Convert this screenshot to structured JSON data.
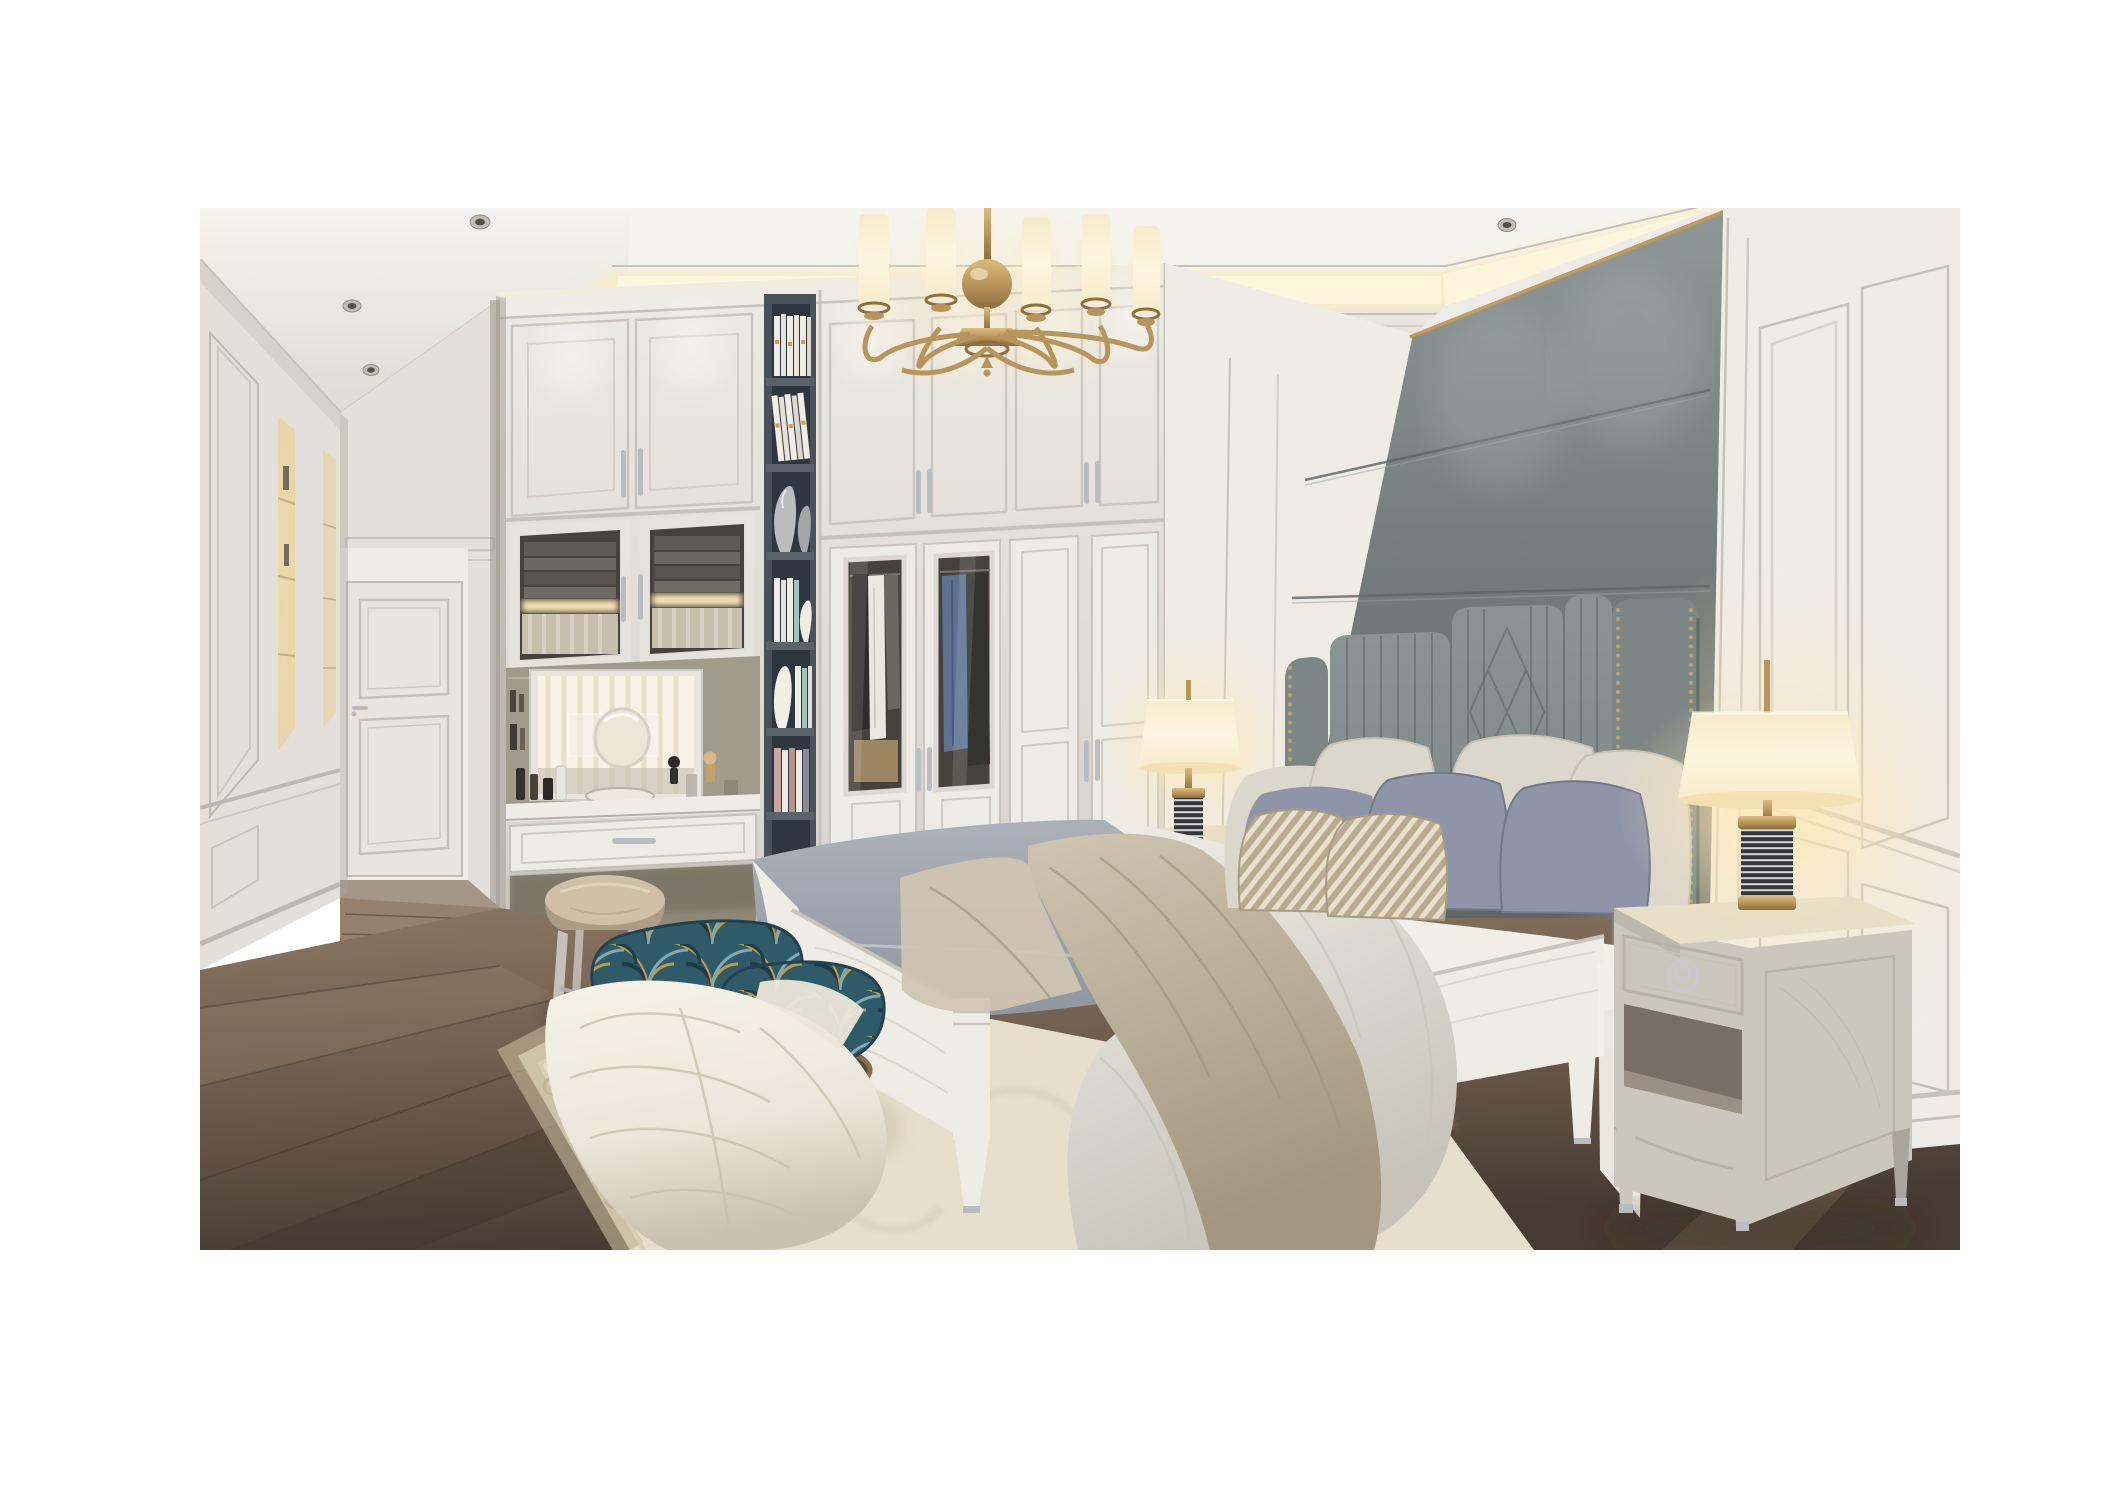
{
  "image": {
    "type": "3d-interior-render",
    "subject": "luxury neoclassical bedroom with built-in white wardrobes, gray upholstered headboard wall, vanity nook and hallway",
    "room_features": [
      "tray ceiling with warm cove lighting",
      "recessed ceiling downlights",
      "brass chandelier with cylindrical white shades",
      "white classical wall paneling and wainscot",
      "gray-green upholstered feature wall with brass trim line",
      "channel-tufted headboard with nailhead wings and diamond quilting",
      "built-in white wardrobe with two glass garment doors",
      "dark slate open bookshelf column with books and vases",
      "vanity nook with mirror, cosmetics and leather stool",
      "hallway with white paneled door and lit display niches",
      "dark stained oak plank flooring",
      "cream damask area rug"
    ],
    "furniture": {
      "bed": "white wood frame, gray fitted mattress, white duvet, taupe throw",
      "pillows": {
        "cream_large": 4,
        "lavender_gray": 3,
        "striped_accent": 2
      },
      "nightstands": 2,
      "table_lamps": 2,
      "bench": "teal and gold fan-patterned upholstery with bronze legs and cream throw",
      "stool": "round beige leather vanity stool",
      "side_table": "round bronze accent table with dark glass top"
    },
    "lighting": {
      "chandelier": {
        "material": "brushed brass",
        "visible_shades": 5,
        "arms": 6
      },
      "cove_light": "warm indirect",
      "downlights_visible": 16,
      "lamp_style": "cream drum shade, brass fittings, black-and-white ribbed column base"
    },
    "bookshelf": {
      "shelves": 6,
      "contents": [
        "white books with orange accents",
        "leaning white books",
        "two silver vases",
        "books and white ceramic vase",
        "tall white vase with books",
        "pink and white books"
      ]
    },
    "wardrobe": {
      "glass_doors": 2,
      "solid_lower_doors": 2,
      "upper_cabinet_doors": 5,
      "handle_finish": "polished chrome"
    }
  },
  "colors": {
    "ceilingLight": "#f5f3ef",
    "ceilingShade": "#d8d4ce",
    "coveGlow": "#ffedb8",
    "coveCore": "#fdf6dd",
    "wallWhite": "#efece7",
    "wallShade": "#d6d2cb",
    "wallWarm": "#e9e3d7",
    "wardrobeFace": "#edebe6",
    "wardrobeShade": "#d4d0c9",
    "panelLine": "#c6c2bb",
    "hallWall": "#e4e0d9",
    "doorFace": "#e9e5de",
    "shelfDark": "#49525b",
    "shelfInner": "#2e363f",
    "shelfEdge": "#5a636c",
    "bookWhite": "#f0ede6",
    "bookAccent": "#d99a4e",
    "bookTeal": "#9fc3bd",
    "bookPink": "#c9a8a2",
    "glassDark": "#45423e",
    "glassWarm": "#f3e0b0",
    "clothesDark": "#35342f",
    "clothesBlue": "#5d7291",
    "clothesWhite": "#e9e7e2",
    "mirrorBright": "#f8f3e6",
    "mirrorStripe": "#e6ddc8",
    "nicheOlive": "#a19b8b",
    "counterWhite": "#f0ede7",
    "grayWallTop": "#8d9795",
    "grayWall": "#75807e",
    "grayWallDark": "#5c6765",
    "goldTrim": "#c29a55",
    "headboard": "#7c8785",
    "headboardLight": "#8a9593",
    "headboardDark": "#59645f",
    "headboardNail": "#caa768",
    "bedWhite": "#efece5",
    "bedWhiteShade": "#d5d1c7",
    "mattress": "#abb1b9",
    "mattressShade": "#8f96a0",
    "duvet": "#f1eee8",
    "duvetShade": "#c8c4b9",
    "throwTaupe": "#cfc5b0",
    "throwTaupeDark": "#a3977f",
    "pillowCream": "#dcd7cb",
    "pillowCreamShade": "#bfbaad",
    "pillowLav": "#8f95a9",
    "pillowLavShade": "#71778d",
    "pillowStripeBase": "#b9ab8e",
    "pillowStripeLight": "#e8e0cc",
    "benchTeal": "#2f5a68",
    "benchNavy": "#1d3a46",
    "benchGold": "#c09a42",
    "benchBlue": "#7fa9b5",
    "throwWhite": "#ece7da",
    "throwWhiteShade": "#c9c2ae",
    "stoolLeather": "#cfc1a8",
    "stoolLeatherDark": "#ab9d84",
    "stoolLeg": "#c6c1b8",
    "tableBronze": "#8a6a4a",
    "tableGlass": "#57493d",
    "nsWood": "#ccc7bd",
    "nsWoodShade": "#aba69b",
    "nsTopLit": "#e9dfc6",
    "nsInnerDark": "#776f63",
    "lampShade": "#f6ecca",
    "lampShadeHot": "#fdf6df",
    "brass": "#b8955a",
    "brassDark": "#8d6f3e",
    "ribbedDark": "#35353a",
    "ribbedLight": "#d8d8da",
    "floorWood": "#6e5d4d",
    "floorWoodDark": "#473c32",
    "floorWoodLight": "#8a7661",
    "hallFloor": "#96826c",
    "rugField": "#e6dfcb",
    "rugBorder": "#d8cfb6",
    "rugMotif": "#bfb495",
    "rugShadow": "#b7ad93",
    "chromeHandle": "#c9c9cd",
    "silver": "#b9bcc0",
    "glowWarm": "#ffe9b4",
    "shadow": "rgba(55,45,35,0.35)"
  }
}
